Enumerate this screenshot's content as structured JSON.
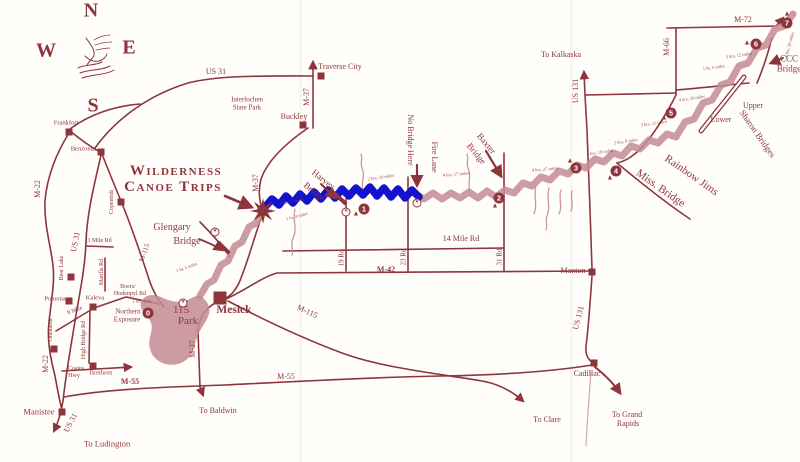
{
  "colors": {
    "ink": "#8e353c",
    "river": "#c48b93",
    "highlight": "#1212cf",
    "paper": "#fffefb"
  },
  "icons": {
    "camp": "▲",
    "access": "✶"
  },
  "compass": {
    "n": "N",
    "e": "E",
    "s": "S",
    "w": "W"
  },
  "title": {
    "line1": "Wilderness",
    "line2": "Canoe Trips"
  },
  "roads": {
    "us31_top": "US 31",
    "us31_west": "US 31",
    "us31_manistee": "US 31",
    "us131_north": "US 131",
    "us131_south": "US 131",
    "m37_north": "M-37",
    "m37_mid": "M-37",
    "m37_south": "M-37",
    "m22_north": "M-22",
    "m22_south": "M-22",
    "m66": "M-66",
    "m72": "M-72",
    "m42": "M-42",
    "m55_west": "M-55",
    "m55_mid": "M-55",
    "m115_north": "M-115",
    "m115_south": "M-115",
    "mile14": "14 Mile Rd",
    "mile13": "13 Mile Rd",
    "rd19": "19 Rd",
    "rd23": "23 Rd",
    "rd31": "31 Rd",
    "high_bridge": "High Bridge Rd",
    "coates_line1": "Coates",
    "coates_line2": "Hwy",
    "marilla": "Marilla Rd",
    "nine_mile": "9 Mile",
    "boers_line1": "Boers/",
    "boers_line2": "Hodenpyl Rd"
  },
  "towns": {
    "frankfort": "Frankfort",
    "benzonia": "Benzonia",
    "copemish": "Copemish",
    "bear_lake": "Bear Lake",
    "pomona": "Pomona",
    "kaleva": "Kaleva",
    "onekama": "Onekama",
    "brethren": "Brethren",
    "manistee": "Manistee",
    "buckley": "Buckley",
    "traverse_city": "Traverse City",
    "mesick": "Mesick",
    "manton": "Manton",
    "cadillac": "Cadillac",
    "interlochen_line1": "Interlochen",
    "interlochen_line2": "State Park"
  },
  "destinations": {
    "kalkaska": "To Kalkaska",
    "baldwin": "To Baldwin",
    "ludington": "To Ludington",
    "clare": "To Clare",
    "grand_rapids_line1": "To Grand",
    "grand_rapids_line2": "Rapids"
  },
  "bridges": {
    "glengary_line1": "Glengary",
    "glengary_line2": "Bridge",
    "harvey_line1": "Harvey",
    "harvey_line2": "Bridge",
    "baxter_line1": "Baxter",
    "baxter_line2": "Bridge",
    "ccc_line1": "CCC",
    "ccc_line2": "Bridge",
    "sharon": "Sharon Bridges",
    "upper": "Upper",
    "lower": "Lower",
    "miss": "Miss. Bridge",
    "rainbow_jims": "Rainbow Jims",
    "fire_lane": "Fire Lane",
    "no_bridge": "No Bridge Here"
  },
  "pois": {
    "park115_line1": "115",
    "park115_line2": "Park",
    "northern_line1": "Northern",
    "northern_line2": "Exposure"
  },
  "waypoints": [
    "0",
    "1",
    "2",
    "3",
    "4",
    "5",
    "6",
    "7"
  ],
  "times": {
    "glengary": "1 hr, 5 miles",
    "base": "1 hr, 4 miles",
    "harvey_west": "2 hrs, 7 miles",
    "harvey_east": "2 hrs, 10 miles",
    "fire_baxter": "4 hrs, 17 miles",
    "baxter_3": "4 hrs, 27 miles",
    "wp4": "4 hrs, 19 miles",
    "wp4b": "2 hrs, 9 miles",
    "wp5": "3 hrs, 15 miles",
    "sharon": "4 hrs, 20 miles",
    "upper": "1 hr, 6 miles",
    "wp6": "3 hrs, 12 miles",
    "wp7": "4 hrs, 26 miles",
    "northern": "2 hrs, 8 mi"
  }
}
